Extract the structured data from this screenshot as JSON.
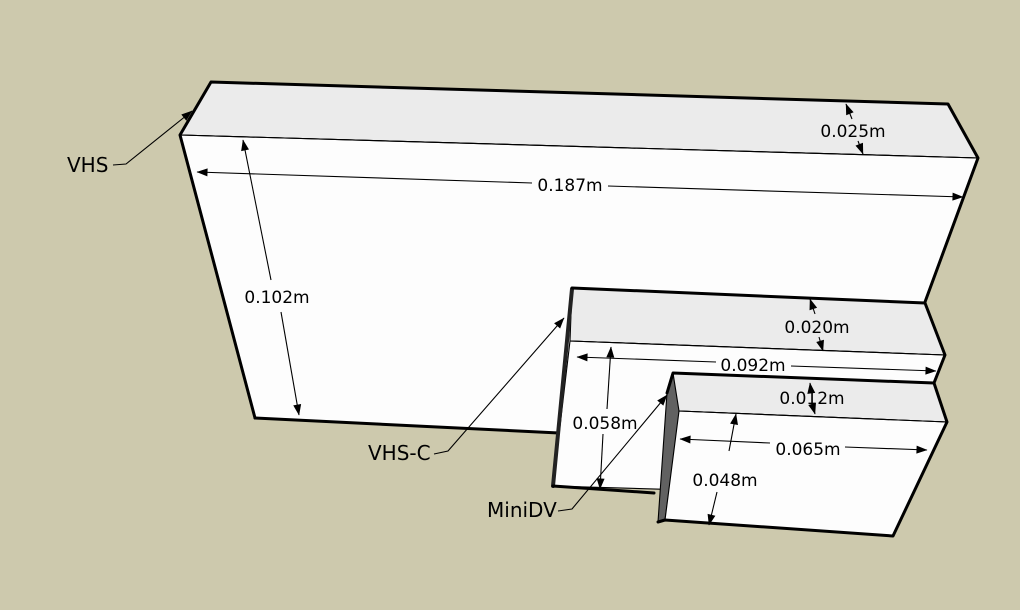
{
  "viewport": {
    "background_color": "#cdc9ad",
    "top_face_color": "#ebebeb",
    "front_face_color": "#fdfdfd",
    "side_face_color": "#616161",
    "edge_color": "#000000"
  },
  "objects": [
    {
      "label": "VHS",
      "dims": {
        "width": "0.187m",
        "height": "0.102m",
        "depth": "0.025m"
      }
    },
    {
      "label": "VHS-C",
      "dims": {
        "width": "0.092m",
        "height": "0.058m",
        "depth": "0.020m"
      }
    },
    {
      "label": "MiniDV",
      "dims": {
        "width": "0.065m",
        "height": "0.048m",
        "depth": "0.012m"
      }
    }
  ]
}
